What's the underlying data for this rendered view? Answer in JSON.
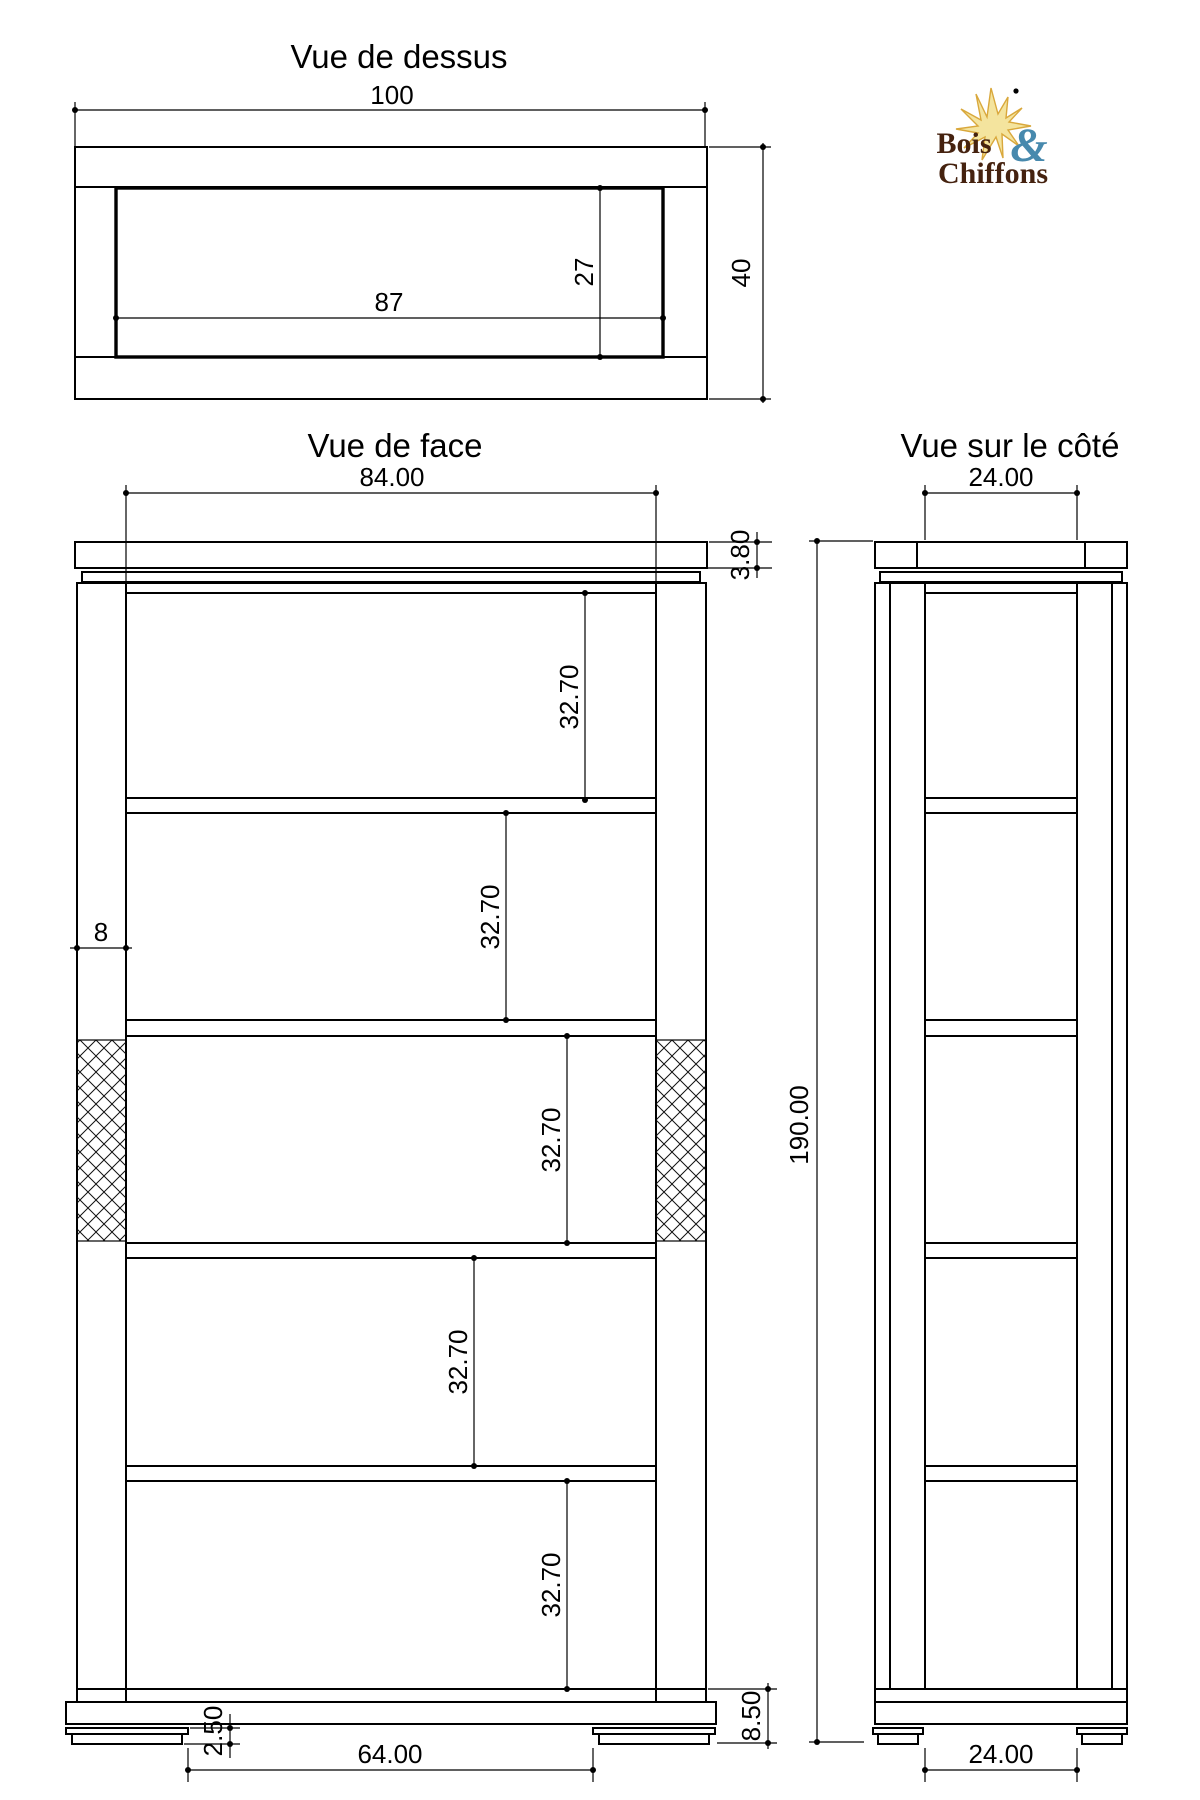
{
  "titles": {
    "top": "Vue de dessus",
    "front": "Vue de face",
    "side": "Vue sur le côté"
  },
  "logo": {
    "word1": "Bois",
    "amp": "&",
    "word2": "Chiffons"
  },
  "top_view": {
    "width": "100",
    "inner_width": "87",
    "inner_depth": "27",
    "depth": "40"
  },
  "front_view": {
    "width": "84.00",
    "board_thickness": "3.80",
    "post_width": "8",
    "openings": [
      "32.70",
      "32.70",
      "32.70",
      "32.70",
      "32.70"
    ],
    "height": "190.00",
    "base_height": "8.50",
    "foot_height": "2.50",
    "feet_span": "64.00"
  },
  "side_view": {
    "width_top": "24.00",
    "width_bottom": "24.00"
  },
  "colors": {
    "line": "#000000",
    "logo_brown": "#45220f",
    "logo_blue": "#4789ad",
    "sun_fill": "#f4e49e",
    "sun_stroke": "#d9a83c"
  }
}
